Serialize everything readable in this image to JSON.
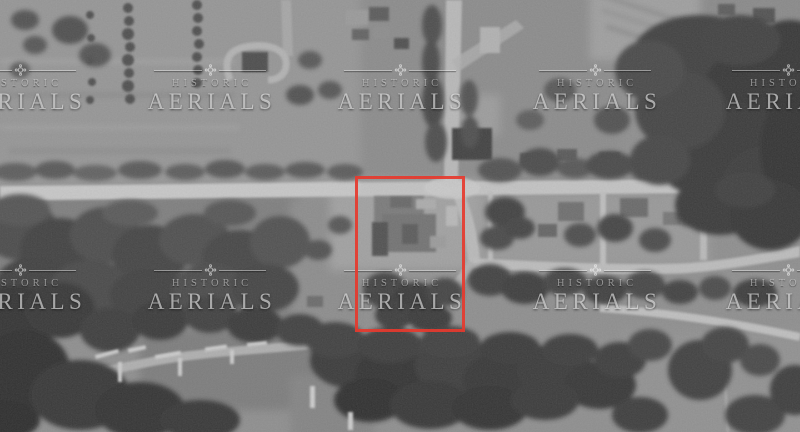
{
  "watermark": {
    "brand_line1": "HISTORIC",
    "brand_line2": "AERIALS",
    "logo_icon": "rosette-ornament",
    "text_color": "#eeeeee",
    "tile_count": 10
  },
  "annotation": {
    "shape": "rectangle",
    "stroke_color": "#e63a2e",
    "purpose": "highlights central building parcel at the crossroads"
  },
  "photo": {
    "type": "grayscale-historic-aerial-photograph",
    "description": "Black-and-white aerial photo of a small town: an east-west main road crosses a north-south road at center; orchard rows and farm fields above, a large flagged building complex below the intersection, dense tree canopy and lakeshore docks at bottom left, dark woods and water at top right."
  }
}
